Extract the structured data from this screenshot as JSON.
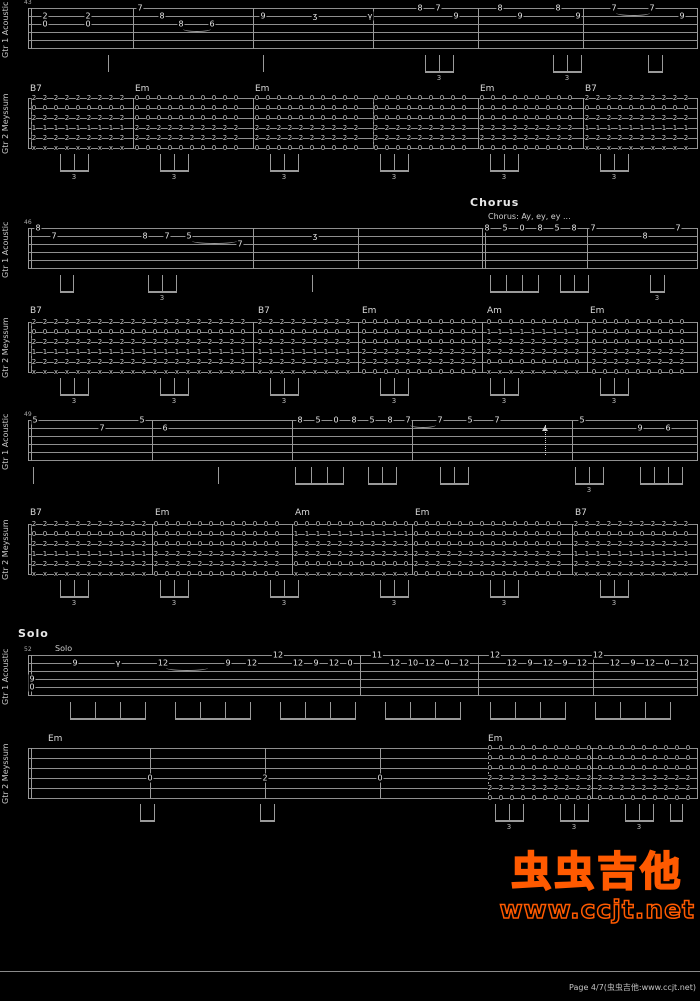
{
  "page": {
    "background": "#000000",
    "footer_text": "Page 4/7(虫虫吉他:www.ccjt.net)"
  },
  "watermark": {
    "title": "虫虫吉他",
    "url": "www.ccjt.net",
    "color": "#ff6100"
  },
  "track_labels": {
    "gtr1": "Gtr 1 Acoustic",
    "gtr2": "Gtr 2 Meyssum"
  },
  "chord_shapes": {
    "B7": [
      "2",
      "0",
      "2",
      "1",
      "2",
      "x"
    ],
    "Em": [
      "0",
      "0",
      "0",
      "2",
      "2",
      "0"
    ],
    "Am": [
      "0",
      "1",
      "2",
      "2",
      "0",
      "x"
    ]
  },
  "systems": [
    {
      "measure_no": "43",
      "chords_y": 84,
      "chords": [
        [
          30,
          "B7"
        ],
        [
          135,
          "Em"
        ],
        [
          255,
          "Em"
        ],
        [
          480,
          "Em"
        ],
        [
          585,
          "B7"
        ]
      ],
      "gtr1": {
        "top": 8,
        "barlines": [
          28,
          31,
          133,
          253,
          373,
          478,
          583,
          697
        ],
        "notes": [
          [
            45,
            2,
            "2"
          ],
          [
            45,
            3,
            "0"
          ],
          [
            88,
            2,
            "2"
          ],
          [
            88,
            3,
            "0"
          ],
          [
            140,
            1,
            "7"
          ],
          [
            162,
            2,
            "8"
          ],
          [
            181,
            3,
            "8"
          ],
          [
            212,
            3,
            "6"
          ],
          [
            263,
            2,
            "9"
          ],
          [
            315,
            2,
            "ʒ"
          ],
          [
            370,
            2,
            "γ"
          ],
          [
            420,
            1,
            "8"
          ],
          [
            438,
            1,
            "7"
          ],
          [
            456,
            2,
            "9"
          ],
          [
            500,
            1,
            "8"
          ],
          [
            520,
            2,
            "9"
          ],
          [
            558,
            1,
            "8"
          ],
          [
            578,
            2,
            "9"
          ],
          [
            614,
            1,
            "7"
          ],
          [
            652,
            1,
            "7"
          ],
          [
            682,
            2,
            "9"
          ]
        ],
        "ties": [
          [
            183,
            28,
            3
          ],
          [
            616,
            34,
            1
          ]
        ],
        "stems": [
          [
            108,
            1,
            12,
            0
          ],
          [
            263,
            1,
            12,
            0
          ],
          [
            425,
            3,
            14,
            1
          ],
          [
            553,
            3,
            14,
            1
          ],
          [
            648,
            2,
            14,
            0
          ]
        ]
      },
      "gtr2": {
        "top": 98,
        "barlines": [
          28,
          31,
          133,
          253,
          373,
          478,
          583,
          697
        ],
        "segments": [
          [
            34,
            128,
            "B7"
          ],
          [
            137,
            248,
            "Em"
          ],
          [
            257,
            368,
            "Em"
          ],
          [
            376,
            474,
            "Em"
          ],
          [
            482,
            578,
            "Em"
          ],
          [
            587,
            694,
            "B7"
          ]
        ],
        "beams": [
          [
            60,
            3,
            14,
            1
          ],
          [
            160,
            3,
            14,
            1
          ],
          [
            270,
            3,
            14,
            1
          ],
          [
            380,
            3,
            14,
            1
          ],
          [
            490,
            3,
            14,
            1
          ],
          [
            600,
            3,
            14,
            1
          ]
        ]
      }
    },
    {
      "measure_no": "46",
      "chords_y": 306,
      "header": {
        "title": "Chorus",
        "x": 470,
        "y": 197,
        "sub": "Chorus: Ay, ey, ey ...",
        "sub_x": 488,
        "sub_y": 212
      },
      "chords": [
        [
          30,
          "B7"
        ],
        [
          258,
          "B7"
        ],
        [
          362,
          "Em"
        ],
        [
          487,
          "Am"
        ],
        [
          590,
          "Em"
        ]
      ],
      "gtr1": {
        "top": 228,
        "barlines": [
          28,
          31,
          253,
          358,
          482,
          485,
          587,
          697
        ],
        "notes": [
          [
            38,
            1,
            "8"
          ],
          [
            54,
            2,
            "7"
          ],
          [
            145,
            2,
            "8"
          ],
          [
            167,
            2,
            "7"
          ],
          [
            189,
            2,
            "5"
          ],
          [
            240,
            3,
            "7"
          ],
          [
            315,
            2,
            "ʒ"
          ],
          [
            487,
            1,
            "8"
          ],
          [
            505,
            1,
            "5"
          ],
          [
            522,
            1,
            "0"
          ],
          [
            540,
            1,
            "8"
          ],
          [
            557,
            1,
            "5"
          ],
          [
            574,
            1,
            "8"
          ],
          [
            593,
            1,
            "7"
          ],
          [
            645,
            2,
            "8"
          ],
          [
            678,
            1,
            "7"
          ]
        ],
        "ties": [
          [
            192,
            45,
            2
          ]
        ],
        "stems": [
          [
            60,
            2,
            13,
            0
          ],
          [
            148,
            3,
            14,
            1
          ],
          [
            312,
            1,
            12,
            0
          ],
          [
            490,
            4,
            16,
            0
          ],
          [
            560,
            3,
            14,
            0
          ],
          [
            650,
            2,
            14,
            1
          ]
        ]
      },
      "gtr2": {
        "top": 322,
        "barlines": [
          28,
          31,
          253,
          358,
          482,
          587,
          697
        ],
        "segments": [
          [
            34,
            250,
            "B7"
          ],
          [
            260,
            355,
            "B7"
          ],
          [
            364,
            479,
            "Em"
          ],
          [
            489,
            584,
            "Am"
          ],
          [
            594,
            694,
            "Em"
          ]
        ],
        "beams": [
          [
            60,
            3,
            14,
            1
          ],
          [
            160,
            3,
            14,
            1
          ],
          [
            270,
            3,
            14,
            1
          ],
          [
            380,
            3,
            14,
            1
          ],
          [
            490,
            3,
            14,
            1
          ],
          [
            600,
            3,
            14,
            1
          ]
        ]
      }
    },
    {
      "measure_no": "49",
      "chords_y": 508,
      "chords": [
        [
          30,
          "B7"
        ],
        [
          155,
          "Em"
        ],
        [
          295,
          "Am"
        ],
        [
          415,
          "Em"
        ],
        [
          575,
          "B7"
        ]
      ],
      "gtr1": {
        "top": 420,
        "barlines": [
          28,
          31,
          152,
          292,
          412,
          572,
          697
        ],
        "notes": [
          [
            35,
            1,
            "5"
          ],
          [
            102,
            2,
            "7"
          ],
          [
            142,
            1,
            "5"
          ],
          [
            165,
            2,
            "6"
          ],
          [
            300,
            1,
            "8"
          ],
          [
            318,
            1,
            "5"
          ],
          [
            336,
            1,
            "0"
          ],
          [
            354,
            1,
            "8"
          ],
          [
            372,
            1,
            "5"
          ],
          [
            390,
            1,
            "8"
          ],
          [
            408,
            1,
            "7"
          ],
          [
            440,
            1,
            "7"
          ],
          [
            470,
            1,
            "5"
          ],
          [
            497,
            1,
            "7"
          ],
          [
            582,
            1,
            "5"
          ],
          [
            640,
            2,
            "9"
          ],
          [
            668,
            2,
            "6"
          ]
        ],
        "ties": [
          [
            410,
            26,
            1
          ]
        ],
        "marks": [
          [
            545,
            "strum-arrow"
          ]
        ],
        "stems": [
          [
            33,
            1,
            12,
            0
          ],
          [
            218,
            1,
            12,
            0
          ],
          [
            295,
            4,
            16,
            0
          ],
          [
            368,
            3,
            14,
            0
          ],
          [
            440,
            3,
            14,
            0
          ],
          [
            575,
            3,
            14,
            1
          ],
          [
            640,
            4,
            14,
            0
          ]
        ]
      },
      "gtr2": {
        "top": 524,
        "barlines": [
          28,
          31,
          152,
          292,
          412,
          572,
          697
        ],
        "segments": [
          [
            34,
            150,
            "B7"
          ],
          [
            156,
            290,
            "Em"
          ],
          [
            296,
            410,
            "Am"
          ],
          [
            416,
            570,
            "Em"
          ],
          [
            576,
            694,
            "B7"
          ]
        ],
        "beams": [
          [
            60,
            3,
            14,
            1
          ],
          [
            160,
            3,
            14,
            1
          ],
          [
            270,
            3,
            14,
            1
          ],
          [
            380,
            3,
            14,
            1
          ],
          [
            490,
            3,
            14,
            1
          ],
          [
            600,
            3,
            14,
            1
          ]
        ]
      }
    },
    {
      "measure_no": "52",
      "chords_y": 734,
      "header": {
        "title": "Solo",
        "x": 18,
        "y": 628,
        "sub": "Solo",
        "sub_x": 55,
        "sub_y": 644
      },
      "chords": [
        [
          48,
          "Em"
        ],
        [
          488,
          "Em"
        ]
      ],
      "gtr1": {
        "top": 655,
        "barlines": [
          28,
          31,
          360,
          478,
          593,
          697
        ],
        "notes": [
          [
            32,
            4,
            "9"
          ],
          [
            32,
            5,
            "0"
          ],
          [
            75,
            2,
            "9"
          ],
          [
            118,
            2,
            "γ"
          ],
          [
            163,
            2,
            "12"
          ],
          [
            228,
            2,
            "9"
          ],
          [
            252,
            2,
            "12"
          ],
          [
            278,
            1,
            "12"
          ],
          [
            298,
            2,
            "12"
          ],
          [
            316,
            2,
            "9"
          ],
          [
            334,
            2,
            "12"
          ],
          [
            350,
            2,
            "0"
          ],
          [
            377,
            1,
            "11"
          ],
          [
            395,
            2,
            "12"
          ],
          [
            413,
            2,
            "10"
          ],
          [
            430,
            2,
            "12"
          ],
          [
            447,
            2,
            "0"
          ],
          [
            464,
            2,
            "12"
          ],
          [
            495,
            1,
            "12"
          ],
          [
            512,
            2,
            "12"
          ],
          [
            530,
            2,
            "9"
          ],
          [
            548,
            2,
            "12"
          ],
          [
            565,
            2,
            "9"
          ],
          [
            582,
            2,
            "12"
          ],
          [
            598,
            1,
            "12"
          ],
          [
            615,
            2,
            "12"
          ],
          [
            633,
            2,
            "9"
          ],
          [
            650,
            2,
            "12"
          ],
          [
            667,
            2,
            "0"
          ],
          [
            684,
            2,
            "12"
          ]
        ],
        "ties": [
          [
            166,
            42,
            2
          ]
        ],
        "stems": [
          [
            70,
            4,
            25,
            0
          ],
          [
            175,
            4,
            25,
            0
          ],
          [
            280,
            4,
            25,
            0
          ],
          [
            385,
            4,
            25,
            0
          ],
          [
            490,
            4,
            25,
            0
          ],
          [
            595,
            4,
            25,
            0
          ]
        ]
      },
      "gtr2": {
        "top": 748,
        "barlines": [
          28,
          31,
          150,
          265,
          380,
          488,
          592,
          697
        ],
        "segments": [
          [
            490,
            694,
            "Em"
          ]
        ],
        "extra": [
          [
            150,
            4,
            "0"
          ],
          [
            265,
            4,
            "2"
          ],
          [
            380,
            4,
            "0"
          ]
        ],
        "beams": [
          [
            140,
            2,
            14,
            0
          ],
          [
            260,
            2,
            14,
            0
          ],
          [
            495,
            3,
            14,
            1
          ],
          [
            560,
            3,
            14,
            1
          ],
          [
            625,
            3,
            14,
            1
          ],
          [
            670,
            2,
            12,
            0
          ]
        ]
      }
    }
  ]
}
